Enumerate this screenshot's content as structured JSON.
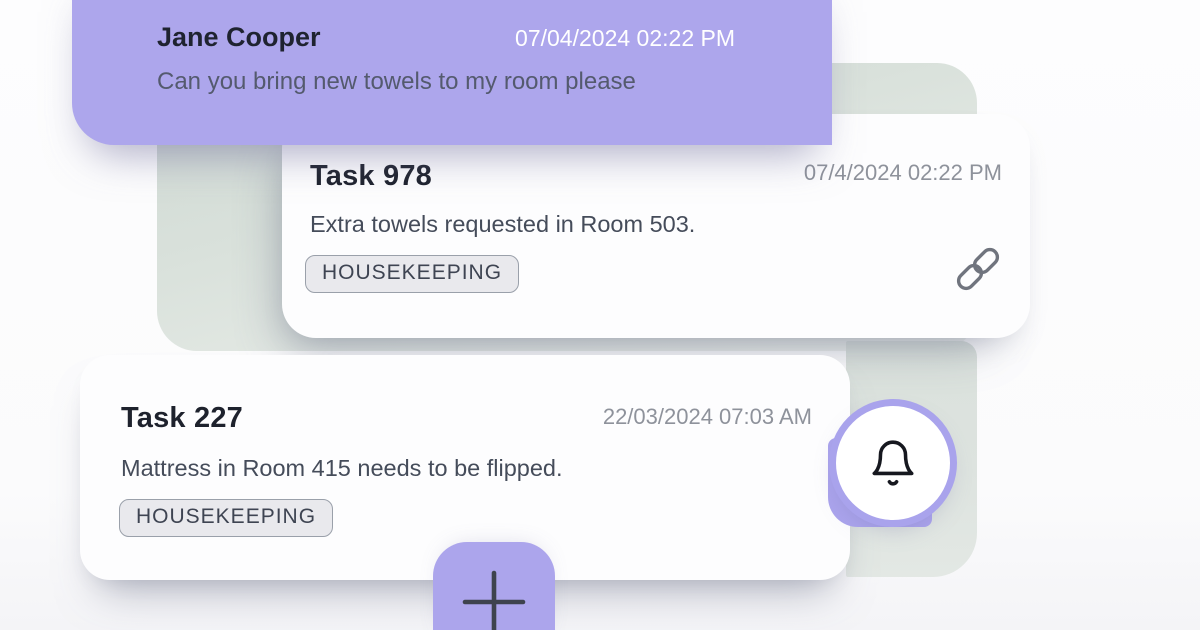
{
  "colors": {
    "accent_purple": "#ada6ec",
    "ring_purple": "#a9a3ec",
    "sage": "#dce3de",
    "card_background": "#fdfdfe",
    "title_text": "#1e222d",
    "muted_text": "#8e929b",
    "body_text": "#454c5a",
    "badge_background": "#e9e9ed",
    "badge_border": "#9aa0aa"
  },
  "chat_bubble": {
    "sender": "Jane Cooper",
    "timestamp": "07/04/2024 02:22 PM",
    "message": "Can you bring new towels to my room please"
  },
  "tasks": [
    {
      "title": "Task 978",
      "timestamp": "07/4/2024 02:22 PM",
      "description": "Extra towels requested in Room 503.",
      "tag": "HOUSEKEEPING",
      "action_icon": "link-icon"
    },
    {
      "title": "Task 227",
      "timestamp": "22/03/2024 07:03 AM",
      "description": "Mattress in Room 415 needs to be flipped.",
      "tag": "HOUSEKEEPING",
      "action_icon": "bell-icon"
    }
  ],
  "fab": {
    "icon": "plus-icon"
  }
}
